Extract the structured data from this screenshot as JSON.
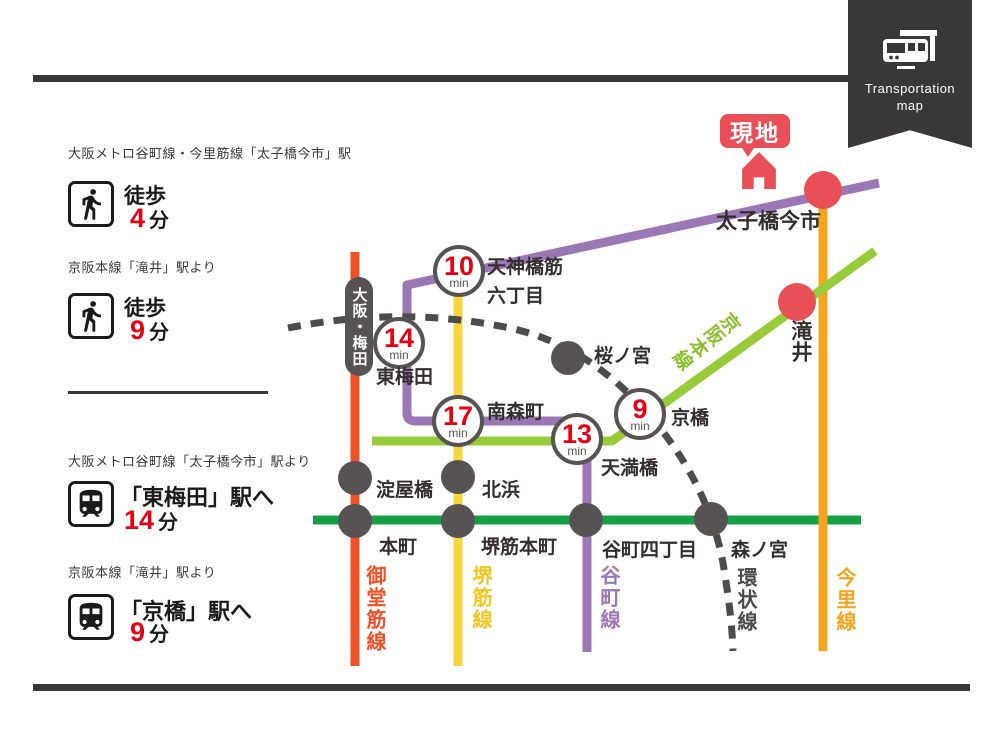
{
  "ribbon": {
    "line1": "Transportation",
    "line2": "map"
  },
  "access": {
    "walk": [
      {
        "heading": "大阪メトロ谷町線・今里筋線「太子橋今市」駅",
        "mode": "徒歩",
        "minutes": "4",
        "unit": "分"
      },
      {
        "heading": "京阪本線「滝井」駅より",
        "mode": "徒歩",
        "minutes": "9",
        "unit": "分"
      }
    ],
    "train": [
      {
        "heading": "大阪メトロ谷町線「太子橋今市」駅より",
        "destination": "「東梅田」駅へ",
        "minutes": "14",
        "unit": "分"
      },
      {
        "heading": "京阪本線「滝井」駅より",
        "destination": "「京橋」駅へ",
        "minutes": "9",
        "unit": "分"
      }
    ]
  },
  "map": {
    "site_label": "現地",
    "terminus_pill": "大阪・梅田",
    "stations": {
      "taishibashi_imaichi": "太子橋今市",
      "takii": "滝井",
      "tenjimbashisuji_line1": "天神橋筋",
      "tenjimbashisuji_line2": "六丁目",
      "higashi_umeda": "東梅田",
      "minamimorimachi": "南森町",
      "sakuranomiya": "桜ノ宮",
      "temmabashi": "天満橋",
      "kyobashi": "京橋",
      "yodoyabashi": "淀屋橋",
      "kitahama": "北浜",
      "hommachi": "本町",
      "sakaisuji_hommachi": "堺筋本町",
      "tanimachi_4chome": "谷町四丁目",
      "morinomiya": "森ノ宮"
    },
    "badges": [
      {
        "minutes": "10",
        "unit": "min"
      },
      {
        "minutes": "14",
        "unit": "min"
      },
      {
        "minutes": "17",
        "unit": "min"
      },
      {
        "minutes": "13",
        "unit": "min"
      },
      {
        "minutes": "9",
        "unit": "min"
      }
    ],
    "line_labels": {
      "midosuji": "御堂筋線",
      "sakaisuji": "堺筋線",
      "tanimachi": "谷町線",
      "kanjo": "環状線",
      "imazato": "今里線",
      "keihan": "京阪本線"
    },
    "colors": {
      "midosuji": "#ed5126",
      "sakaisuji": "#f8d73e",
      "tanimachi": "#9c77b5",
      "chuo_green": "#15a046",
      "keihan": "#97cb39",
      "imazato": "#f5a41d",
      "loop_dashed": "#4d4b4b",
      "station_gray": "#575352",
      "highlight_red": "#e94f57",
      "number_red": "#e60012",
      "frame_dark": "#3a3836"
    }
  }
}
